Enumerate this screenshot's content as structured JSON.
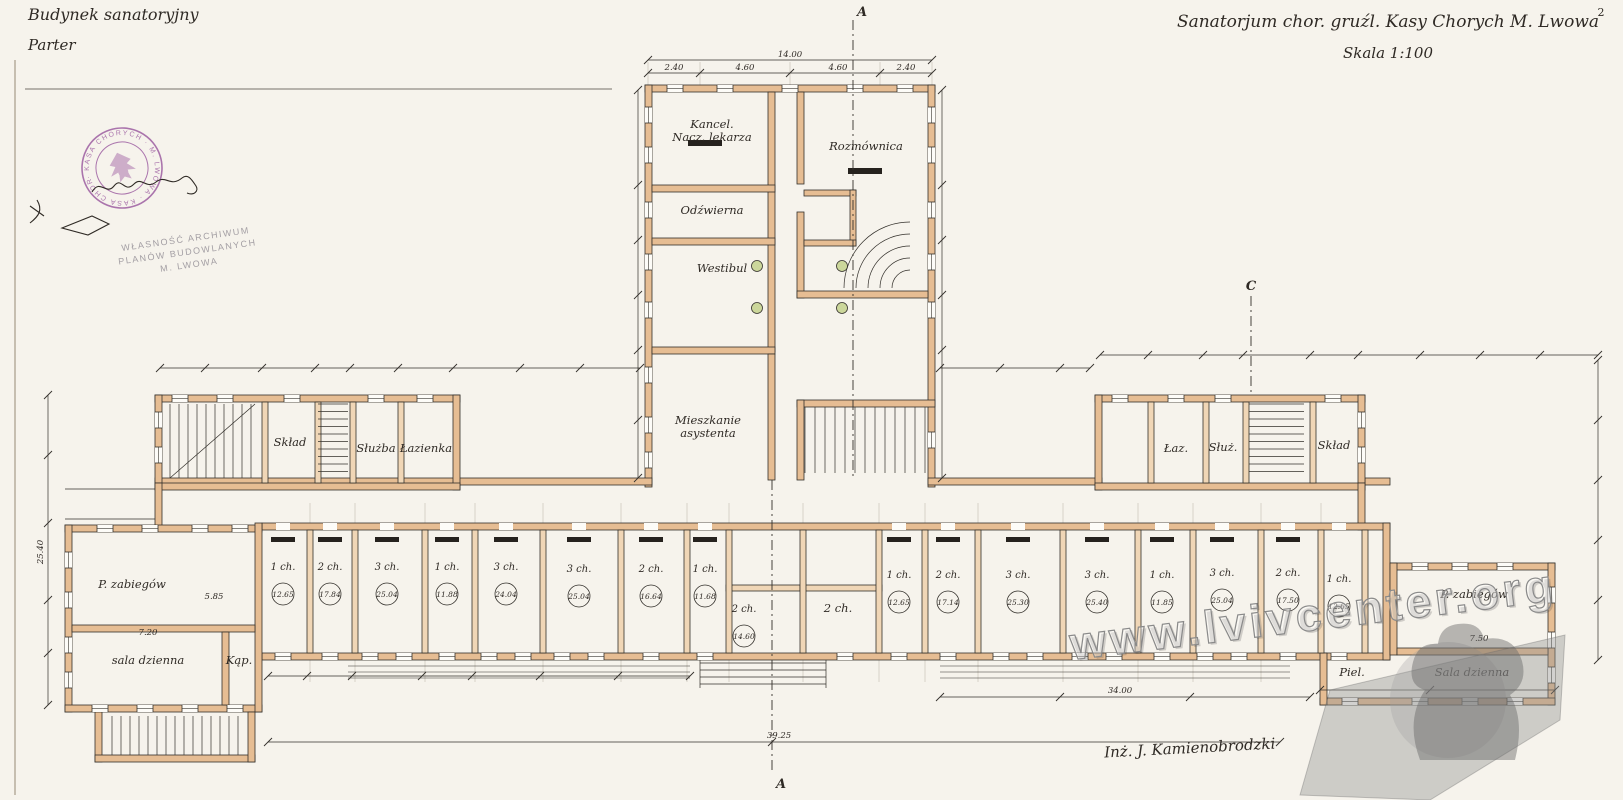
{
  "titles": {
    "top_left_line1": "Budynek sanatoryjny",
    "top_left_line2": "Parter",
    "top_right_line1": "Sanatorjum chor. gruźl. Kasy Chorych M. Lwowa",
    "top_right_line2": "Skala 1:100",
    "page_number": "2"
  },
  "stamps": {
    "round_text": "· KASA CHORYCH · M. LWOWA · KASA CHORYCH ·",
    "archive_lines": [
      "WŁASNOŚĆ ARCHIWUM",
      "PLANÓW BUDOWLANYCH",
      "M. LWOWA"
    ],
    "signature": "Inż. J. Kamienobrodzki"
  },
  "watermark": {
    "text": "www.lvivcenter.org"
  },
  "markers": [
    {
      "label": "A",
      "x": 862,
      "y": 16
    },
    {
      "label": "A",
      "x": 781,
      "y": 788
    },
    {
      "label": "C",
      "x": 1251,
      "y": 290
    }
  ],
  "rooms": [
    {
      "label": "Kancel.",
      "label2": "Nacz. lekarza",
      "x": 712,
      "y": 128
    },
    {
      "label": "Rozmównica",
      "x": 866,
      "y": 150
    },
    {
      "label": "Odźwierna",
      "x": 712,
      "y": 214
    },
    {
      "label": "Westibul",
      "x": 722,
      "y": 272
    },
    {
      "label": "Mieszkanie",
      "label2": "asystenta",
      "x": 708,
      "y": 424
    },
    {
      "label": "Skład",
      "x": 290,
      "y": 446
    },
    {
      "label": "Służba",
      "x": 376,
      "y": 452
    },
    {
      "label": "Łazienka",
      "x": 426,
      "y": 452
    },
    {
      "label": "Łaz.",
      "x": 1176,
      "y": 452
    },
    {
      "label": "Służ.",
      "x": 1223,
      "y": 451
    },
    {
      "label": "Skład",
      "x": 1334,
      "y": 449
    },
    {
      "label": "P. zabiegów",
      "x": 132,
      "y": 588
    },
    {
      "label": "sala dzienna",
      "x": 148,
      "y": 664
    },
    {
      "label": "Kąp.",
      "x": 239,
      "y": 664
    },
    {
      "label": "P. zabiegów",
      "x": 1474,
      "y": 598
    },
    {
      "label": "Piel.",
      "x": 1352,
      "y": 676
    },
    {
      "label": "Sala dzienna",
      "x": 1472,
      "y": 676
    },
    {
      "label": "1 ch.",
      "area": "12.65",
      "x": 283,
      "y": 570
    },
    {
      "label": "2 ch.",
      "area": "17.84",
      "x": 330,
      "y": 570
    },
    {
      "label": "3 ch.",
      "area": "25.04",
      "x": 387,
      "y": 570
    },
    {
      "label": "1 ch.",
      "area": "11.88",
      "x": 447,
      "y": 570
    },
    {
      "label": "3 ch.",
      "area": "24.04",
      "x": 506,
      "y": 570
    },
    {
      "label": "3 ch.",
      "area": "25.04",
      "x": 579,
      "y": 572
    },
    {
      "label": "2 ch.",
      "area": "16.64",
      "x": 651,
      "y": 572
    },
    {
      "label": "1 ch.",
      "area": "11.68",
      "x": 705,
      "y": 572
    },
    {
      "label": "2 ch.",
      "area": "14.60",
      "x": 744,
      "y": 612
    },
    {
      "label": "2 ch.",
      "x": 838,
      "y": 612
    },
    {
      "label": "1 ch.",
      "area": "12.65",
      "x": 899,
      "y": 578
    },
    {
      "label": "2 ch.",
      "area": "17.14",
      "x": 948,
      "y": 578
    },
    {
      "label": "3 ch.",
      "area": "25.30",
      "x": 1018,
      "y": 578
    },
    {
      "label": "3 ch.",
      "area": "25.40",
      "x": 1097,
      "y": 578
    },
    {
      "label": "1 ch.",
      "area": "11.85",
      "x": 1162,
      "y": 578
    },
    {
      "label": "3 ch.",
      "area": "25.04",
      "x": 1222,
      "y": 576
    },
    {
      "label": "2 ch.",
      "area": "17.50",
      "x": 1288,
      "y": 576
    },
    {
      "label": "1 ch.",
      "area": "12.65",
      "x": 1339,
      "y": 582
    }
  ],
  "dimensions": [
    {
      "text": "14.00",
      "x": 790,
      "y": 57
    },
    {
      "text": "2.40",
      "x": 674,
      "y": 70
    },
    {
      "text": "4.60",
      "x": 745,
      "y": 70
    },
    {
      "text": "4.60",
      "x": 838,
      "y": 70
    },
    {
      "text": "2.40",
      "x": 906,
      "y": 70
    },
    {
      "text": "25.40",
      "x": 43,
      "y": 552,
      "rot": -90
    },
    {
      "text": "39.25",
      "x": 779,
      "y": 738
    },
    {
      "text": "34.00",
      "x": 1120,
      "y": 693
    },
    {
      "text": "5.85",
      "x": 214,
      "y": 599
    },
    {
      "text": "7.20",
      "x": 148,
      "y": 635
    },
    {
      "text": "7.50",
      "x": 1479,
      "y": 641
    }
  ],
  "colors": {
    "paper": "#f6f3ec",
    "ink": "#33302b",
    "wall": "#e6bd93",
    "wall_light": "#f0d6b6",
    "stamp": "#95519b",
    "column_green": "#ccd79b",
    "watermark_gray": "#8a8a8a"
  }
}
